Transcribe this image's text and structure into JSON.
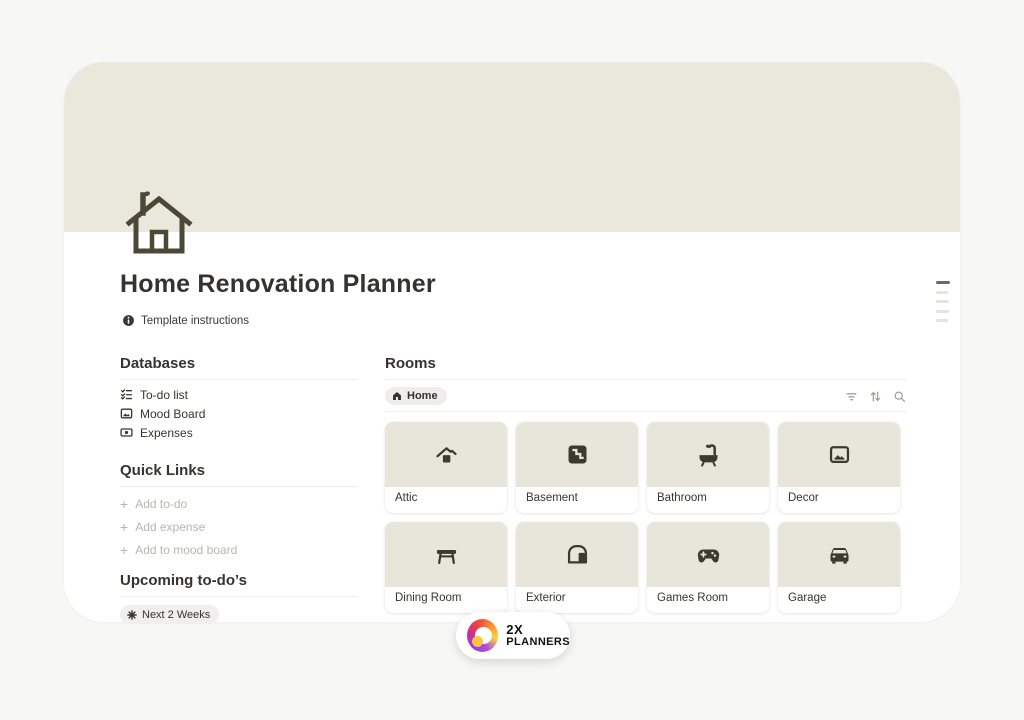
{
  "page": {
    "title": "Home Renovation Planner",
    "instructions_label": "Template instructions"
  },
  "sidebar": {
    "databases": {
      "heading": "Databases",
      "items": [
        {
          "label": "To-do list",
          "icon": "todo-list-icon"
        },
        {
          "label": "Mood Board",
          "icon": "image-icon"
        },
        {
          "label": "Expenses",
          "icon": "banknote-icon"
        }
      ]
    },
    "quick_links": {
      "heading": "Quick Links",
      "items": [
        {
          "label": "Add to-do"
        },
        {
          "label": "Add expense"
        },
        {
          "label": "Add to mood board"
        }
      ],
      "plus_glyph": "+"
    },
    "upcoming": {
      "heading": "Upcoming to-do’s",
      "badge": "Next 2 Weeks"
    }
  },
  "rooms": {
    "heading": "Rooms",
    "tab": "Home",
    "toolbar_icons": [
      "filter-icon",
      "sort-icon",
      "search-icon"
    ],
    "cards": [
      {
        "label": "Attic",
        "icon": "attic-icon"
      },
      {
        "label": "Basement",
        "icon": "basement-icon"
      },
      {
        "label": "Bathroom",
        "icon": "bathtub-icon"
      },
      {
        "label": "Decor",
        "icon": "picture-icon"
      },
      {
        "label": "Dining Room",
        "icon": "table-icon"
      },
      {
        "label": "Exterior",
        "icon": "shed-icon"
      },
      {
        "label": "Games Room",
        "icon": "controller-icon"
      },
      {
        "label": "Garage",
        "icon": "car-icon"
      }
    ]
  },
  "logo": {
    "line1": "2X",
    "line2": "PLANNERS"
  },
  "colors": {
    "page_bg": "#f7f7f5",
    "cover_beige": "#eae7dd",
    "tile_beige": "#e8e5da",
    "icon_olive": "#4b4936",
    "text_dark": "#35332e",
    "muted_gray": "#b8b6b1",
    "logo_gradient": [
      "#8b3ef0",
      "#c9318f",
      "#ef4440",
      "#fb8e2e",
      "#ffd23f"
    ]
  }
}
